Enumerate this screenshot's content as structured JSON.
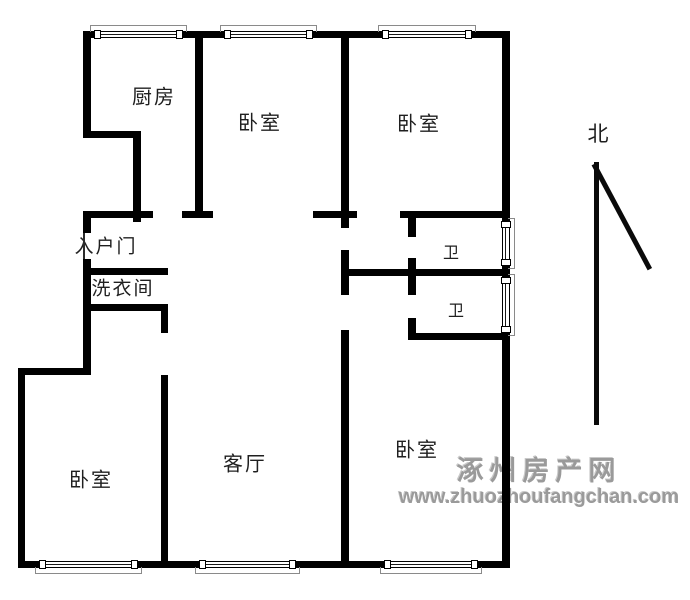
{
  "page": {
    "background": "#ffffff",
    "wall_color": "#000000",
    "watermark_color": "#9a9a9a"
  },
  "plan": {
    "walls": [
      {
        "id": "outer-top",
        "x": 83,
        "y": 31,
        "w": 427,
        "h": 7
      },
      {
        "id": "outer-left-upper",
        "x": 83,
        "y": 31,
        "w": 8,
        "h": 107
      },
      {
        "id": "kitchen-step-h",
        "x": 83,
        "y": 131,
        "w": 58,
        "h": 7
      },
      {
        "id": "kitchen-step-v",
        "x": 133,
        "y": 131,
        "w": 8,
        "h": 91
      },
      {
        "id": "entry-top-h",
        "x": 83,
        "y": 211,
        "w": 70,
        "h": 7
      },
      {
        "id": "outer-left-entry",
        "x": 83,
        "y": 211,
        "w": 8,
        "h": 22
      },
      {
        "id": "outer-left-mid",
        "x": 83,
        "y": 259,
        "w": 8,
        "h": 116
      },
      {
        "id": "laundry-top-h",
        "x": 83,
        "y": 268,
        "w": 85,
        "h": 7
      },
      {
        "id": "laundry-bottom-h",
        "x": 83,
        "y": 304,
        "w": 85,
        "h": 7
      },
      {
        "id": "laundry-right-v",
        "x": 161,
        "y": 304,
        "w": 7,
        "h": 29
      },
      {
        "id": "bedroom-living-divider-v",
        "x": 161,
        "y": 375,
        "w": 7,
        "h": 193
      },
      {
        "id": "left-jut-h",
        "x": 18,
        "y": 368,
        "w": 73,
        "h": 7
      },
      {
        "id": "outer-left-lower",
        "x": 18,
        "y": 368,
        "w": 7,
        "h": 200
      },
      {
        "id": "outer-bottom",
        "x": 18,
        "y": 561,
        "w": 492,
        "h": 7
      },
      {
        "id": "outer-right",
        "x": 502,
        "y": 31,
        "w": 8,
        "h": 537
      },
      {
        "id": "kitchen-bedroom-divider-v",
        "x": 195,
        "y": 31,
        "w": 8,
        "h": 187
      },
      {
        "id": "kitchen-divider-foot-h",
        "x": 182,
        "y": 211,
        "w": 31,
        "h": 7
      },
      {
        "id": "central-divider-upper-v",
        "x": 341,
        "y": 31,
        "w": 8,
        "h": 197
      },
      {
        "id": "bedroom-bottom-stub-h",
        "x": 313,
        "y": 211,
        "w": 44,
        "h": 7
      },
      {
        "id": "bath-top-h",
        "x": 400,
        "y": 211,
        "w": 110,
        "h": 7
      },
      {
        "id": "bath-door-stub-upper-v",
        "x": 408,
        "y": 218,
        "w": 8,
        "h": 19
      },
      {
        "id": "bath-wall-mid-v",
        "x": 408,
        "y": 258,
        "w": 8,
        "h": 37
      },
      {
        "id": "bath-divider-h",
        "x": 341,
        "y": 269,
        "w": 169,
        "h": 7
      },
      {
        "id": "central-divider-mid-v",
        "x": 341,
        "y": 250,
        "w": 8,
        "h": 45
      },
      {
        "id": "bath-door-stub-lower-v",
        "x": 408,
        "y": 318,
        "w": 8,
        "h": 22
      },
      {
        "id": "bath-bottom-h",
        "x": 408,
        "y": 333,
        "w": 102,
        "h": 7
      },
      {
        "id": "central-divider-lower-v",
        "x": 341,
        "y": 330,
        "w": 8,
        "h": 238
      }
    ],
    "windows": [
      {
        "id": "kitchen-top",
        "dir": "top",
        "x": 95,
        "y": 31,
        "len": 87
      },
      {
        "id": "bedroom-mid-top",
        "dir": "top",
        "x": 225,
        "y": 31,
        "len": 87
      },
      {
        "id": "bedroom-right-top",
        "dir": "top",
        "x": 383,
        "y": 31,
        "len": 88
      },
      {
        "id": "bath-upper-right",
        "dir": "right",
        "x": 502,
        "y": 222,
        "len": 43
      },
      {
        "id": "bath-lower-right",
        "dir": "right",
        "x": 502,
        "y": 278,
        "len": 54
      },
      {
        "id": "bedroom-left-bottom",
        "dir": "bottom",
        "x": 40,
        "y": 561,
        "len": 97
      },
      {
        "id": "living-bottom",
        "dir": "bottom",
        "x": 200,
        "y": 561,
        "len": 95
      },
      {
        "id": "bedroom-right-bottom",
        "dir": "bottom",
        "x": 385,
        "y": 561,
        "len": 92
      }
    ],
    "labels": [
      {
        "id": "kitchen",
        "text": "厨房",
        "cx": 154,
        "cy": 95,
        "size": 20
      },
      {
        "id": "bedroom-top-middle",
        "text": "卧室",
        "cx": 260,
        "cy": 121,
        "size": 20
      },
      {
        "id": "bedroom-top-right",
        "text": "卧室",
        "cx": 419,
        "cy": 122,
        "size": 20
      },
      {
        "id": "entry-door",
        "text": "入户门",
        "cx": 106,
        "cy": 245,
        "size": 19
      },
      {
        "id": "laundry",
        "text": "洗衣间",
        "cx": 123,
        "cy": 287,
        "size": 19
      },
      {
        "id": "bath-upper",
        "text": "卫",
        "cx": 452,
        "cy": 251,
        "size": 16
      },
      {
        "id": "bath-lower",
        "text": "卫",
        "cx": 457,
        "cy": 309,
        "size": 16
      },
      {
        "id": "living-room",
        "text": "客厅",
        "cx": 245,
        "cy": 462,
        "size": 20
      },
      {
        "id": "bedroom-bottom-left",
        "text": "卧室",
        "cx": 91,
        "cy": 478,
        "size": 20
      },
      {
        "id": "bedroom-bottom-right",
        "text": "卧室",
        "cx": 417,
        "cy": 448,
        "size": 20
      }
    ],
    "entry_door_line": {
      "x": 83,
      "y": 233,
      "w": 2,
      "h": 26
    },
    "north": {
      "label": "北",
      "label_cx": 598,
      "label_cy": 133,
      "label_size": 21,
      "line": {
        "x": 594,
        "y": 162,
        "w": 5,
        "h": 263
      },
      "diagonal": {
        "x": 596,
        "y": 163,
        "length": 119,
        "angle_deg": 61.9,
        "thickness": 5
      }
    }
  },
  "watermark": {
    "line1": "涿州房产网",
    "line2": "www.zhuozhoufangchan.com",
    "cx": 539,
    "top": 457
  }
}
